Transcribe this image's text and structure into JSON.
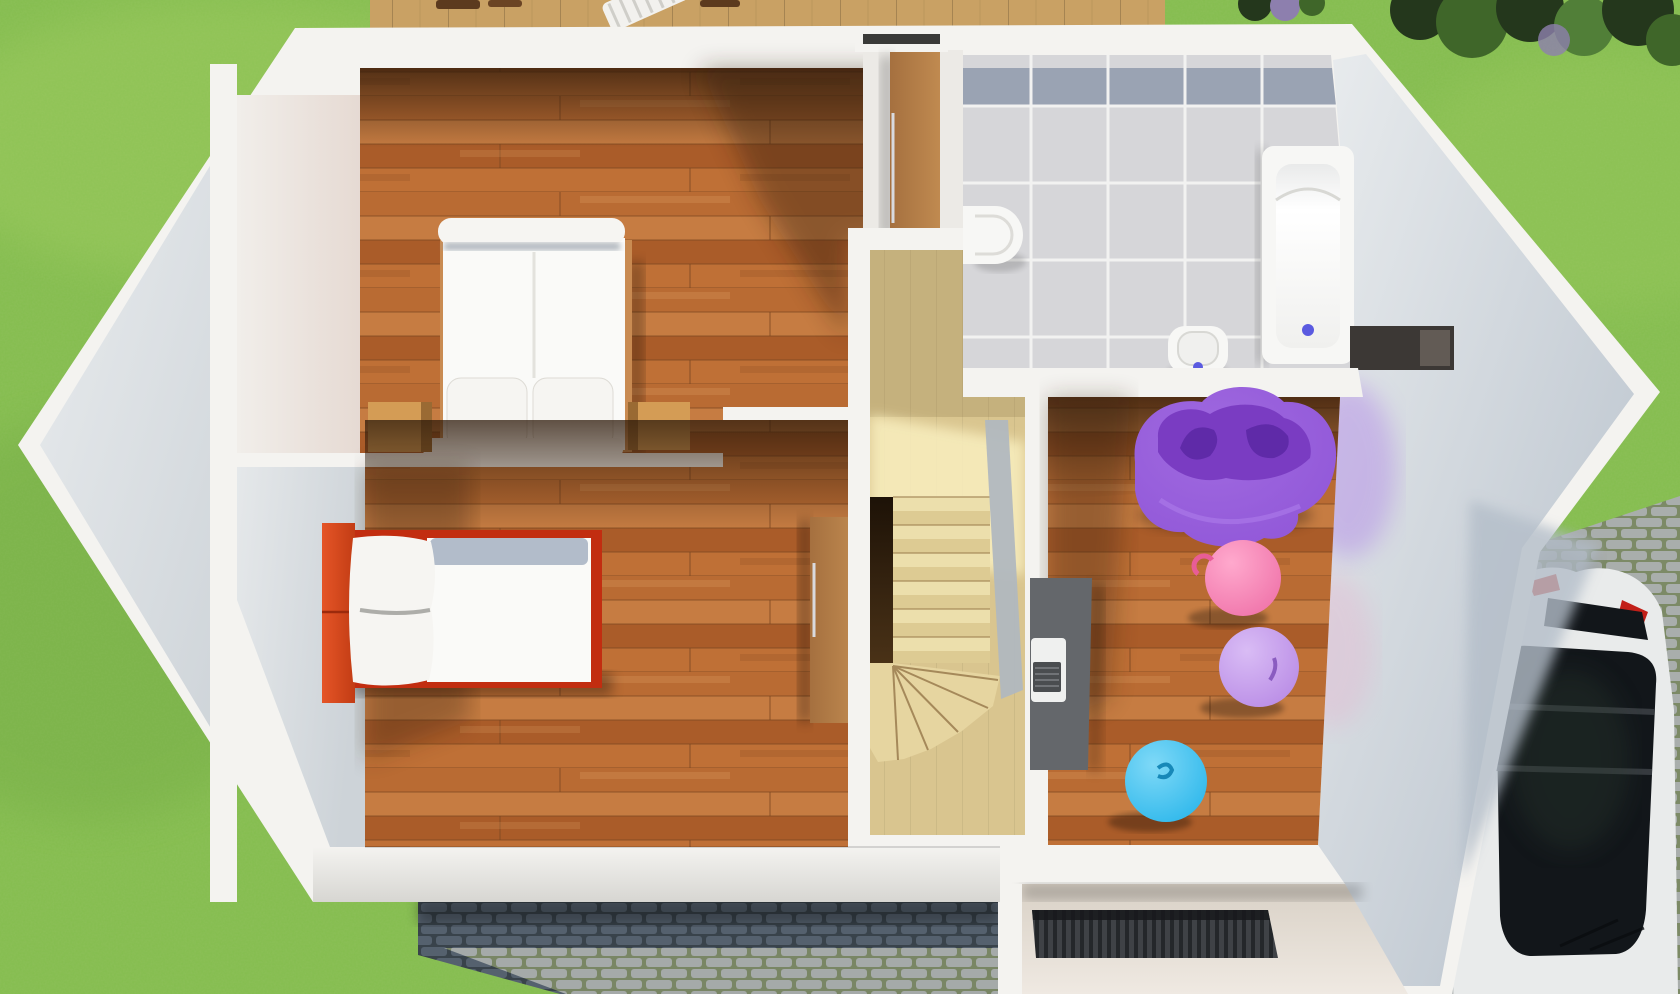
{
  "scene": {
    "kind": "3d-floor-plan-render",
    "view": "top-down aerial render of a house upper floor with garden, deck and driveway"
  },
  "palette": {
    "grass": "#84bd4e",
    "grass_light": "#aad366",
    "grass_dark": "#639a3a",
    "deck_wood": "#c9a164",
    "wood_row_a": "#b96b33",
    "wood_row_b": "#c67c42",
    "wood_row_c": "#aa5c29",
    "wood_row_d": "#bf7036",
    "wall_white": "#f4f3f0",
    "wall_face_light": "#e9ecee",
    "wall_face_gray": "#cdd3d8",
    "wall_face_dark": "#b4bec9",
    "wall_warm": "#e6dad3",
    "nook_floor": "#eceae6",
    "stair_wood": "#d9c58f",
    "stair_wood_lit": "#f7ecbc",
    "stair_void_dark": "#1d1207",
    "railing_gray": "#b1b8bf",
    "tile": "#d6d6d9",
    "tile_band": "#9aa3b3",
    "grout": "#f2f2f1",
    "bath_white": "#f7f7f5",
    "tub_inner": "#ffffff",
    "drain_blue": "#5a5ae0",
    "duvet_white": "#fafaf8",
    "duvet_fold_gray": "#b2bcca",
    "pillow_white": "#f6f5f2",
    "bed_frame_red": "#c22d10",
    "headboard_orange": "#e55527",
    "nightstand_wood": "#d49c55",
    "wardrobe_wood": "#a5703f",
    "wardrobe_wood_light": "#c08a50",
    "beanbag_purple": "#8d52d6",
    "beanbag_inner": "#7a3cc2",
    "beanbag_arms": "#5f2aa8",
    "beanbag_rim": "#a978e8",
    "ball_pink": "#ee6ea6",
    "ball_lavender": "#b687e4",
    "ball_blue": "#25b4ea",
    "desk_gray": "#64676b",
    "laptop_body": "#eff0ef",
    "laptop_keys": "#4a4d50",
    "porch_floor": "#efe9e2",
    "mat_dark": "#3f4246",
    "mat_rib": "#24272a",
    "cobble_light": "#a9aeac",
    "cobble_light_bg": "#7c8a66",
    "cobble_dark": "#55616e",
    "cobble_dark_bg": "#39434b",
    "car_white": "#e9ebeb",
    "car_glass": "#12161a",
    "car_glass_bar": "#3a3f44",
    "car_tail_red": "#c22019",
    "foliage_dark": "#24371c",
    "foliage_mid": "#3f6629",
    "foliage_light": "#517f38",
    "flower_purple": "#8d7fae",
    "shadow_black": "#000000"
  },
  "rooms": [
    {
      "name": "bedroom-upper-left",
      "floor": "hardwood"
    },
    {
      "name": "bedroom-lower-left",
      "floor": "hardwood"
    },
    {
      "name": "bathroom",
      "floor": "gray-tile"
    },
    {
      "name": "kids-room-right",
      "floor": "hardwood"
    },
    {
      "name": "stair-hall",
      "floor": "light-wood"
    },
    {
      "name": "entry-porch",
      "floor": "stone"
    }
  ],
  "objects": [
    "double-bed",
    "pillow",
    "nightstand",
    "wardrobe",
    "single-bed-red",
    "staircase",
    "stair-railing",
    "bathtub",
    "toilet",
    "wall-sink",
    "wall-niche",
    "bean-bag-chair",
    "gym-ball-pink",
    "gym-ball-lavender",
    "gym-ball-blue",
    "desk",
    "laptop",
    "doormat",
    "car",
    "sun-lounger",
    "shrubs",
    "cobblestone-path",
    "cobblestone-driveway",
    "wood-deck",
    "lawn"
  ]
}
